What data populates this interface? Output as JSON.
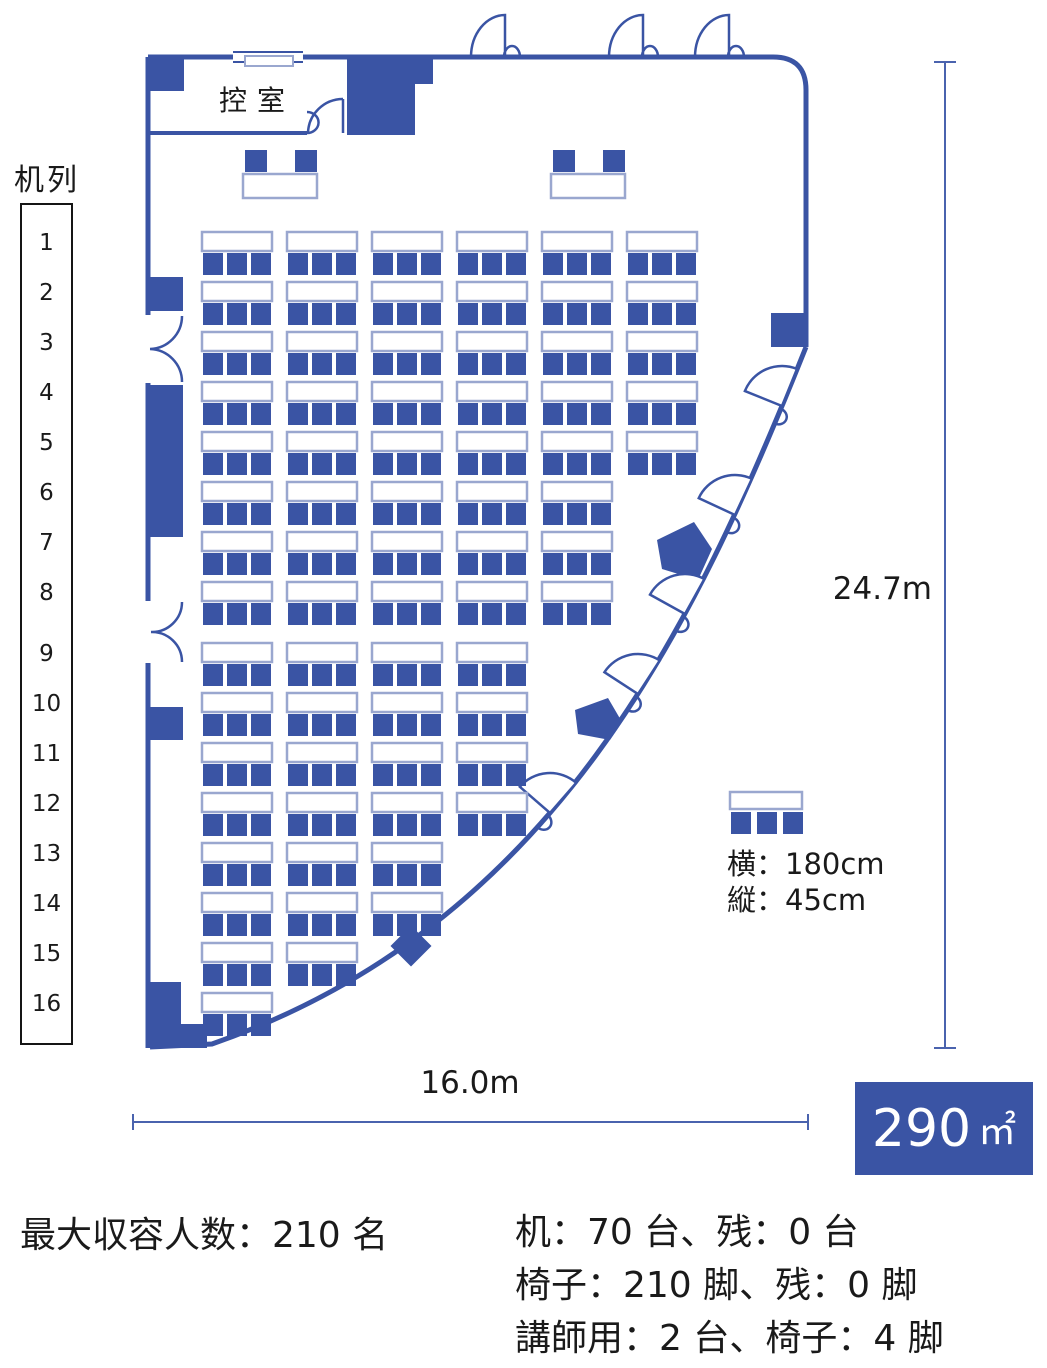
{
  "colors": {
    "primary_blue": "#3A54A4",
    "desk_border": "#9AA7CF",
    "dimension_line": "#4A63AE",
    "badge_bg": "#3A54A4",
    "badge_text": "#FFFFFF",
    "text": "#1A1A1A"
  },
  "sidebar": {
    "title": "机列",
    "row_numbers": [
      "1",
      "2",
      "3",
      "4",
      "5",
      "6",
      "7",
      "8",
      "9",
      "10",
      "11",
      "12",
      "13",
      "14",
      "15",
      "16"
    ]
  },
  "anteroom": {
    "label": "控室"
  },
  "floor_plan": {
    "rows": [
      {
        "row": 1,
        "desks": 6
      },
      {
        "row": 2,
        "desks": 6
      },
      {
        "row": 3,
        "desks": 6
      },
      {
        "row": 4,
        "desks": 6
      },
      {
        "row": 5,
        "desks": 6
      },
      {
        "row": 6,
        "desks": 5
      },
      {
        "row": 7,
        "desks": 5
      },
      {
        "row": 8,
        "desks": 5
      },
      {
        "row": 9,
        "desks": 4
      },
      {
        "row": 10,
        "desks": 4
      },
      {
        "row": 11,
        "desks": 4
      },
      {
        "row": 12,
        "desks": 4
      },
      {
        "row": 13,
        "desks": 3
      },
      {
        "row": 14,
        "desks": 3
      },
      {
        "row": 15,
        "desks": 2
      },
      {
        "row": 16,
        "desks": 1
      }
    ],
    "chairs_per_desk": 3,
    "lecturer_desks": 2
  },
  "dimensions": {
    "height_label": "24.7m",
    "width_label": "16.0m"
  },
  "area_badge": {
    "value": "290",
    "unit": "㎡"
  },
  "desk_legend": {
    "width": "横：180cm",
    "depth": "縦：45cm"
  },
  "summary": {
    "capacity": "最大収容人数：210 名",
    "desks": "机：70 台、残：0 台",
    "chairs": "椅子：210 脚、残：0 脚",
    "lecturer": "講師用：2 台、椅子：4 脚"
  }
}
